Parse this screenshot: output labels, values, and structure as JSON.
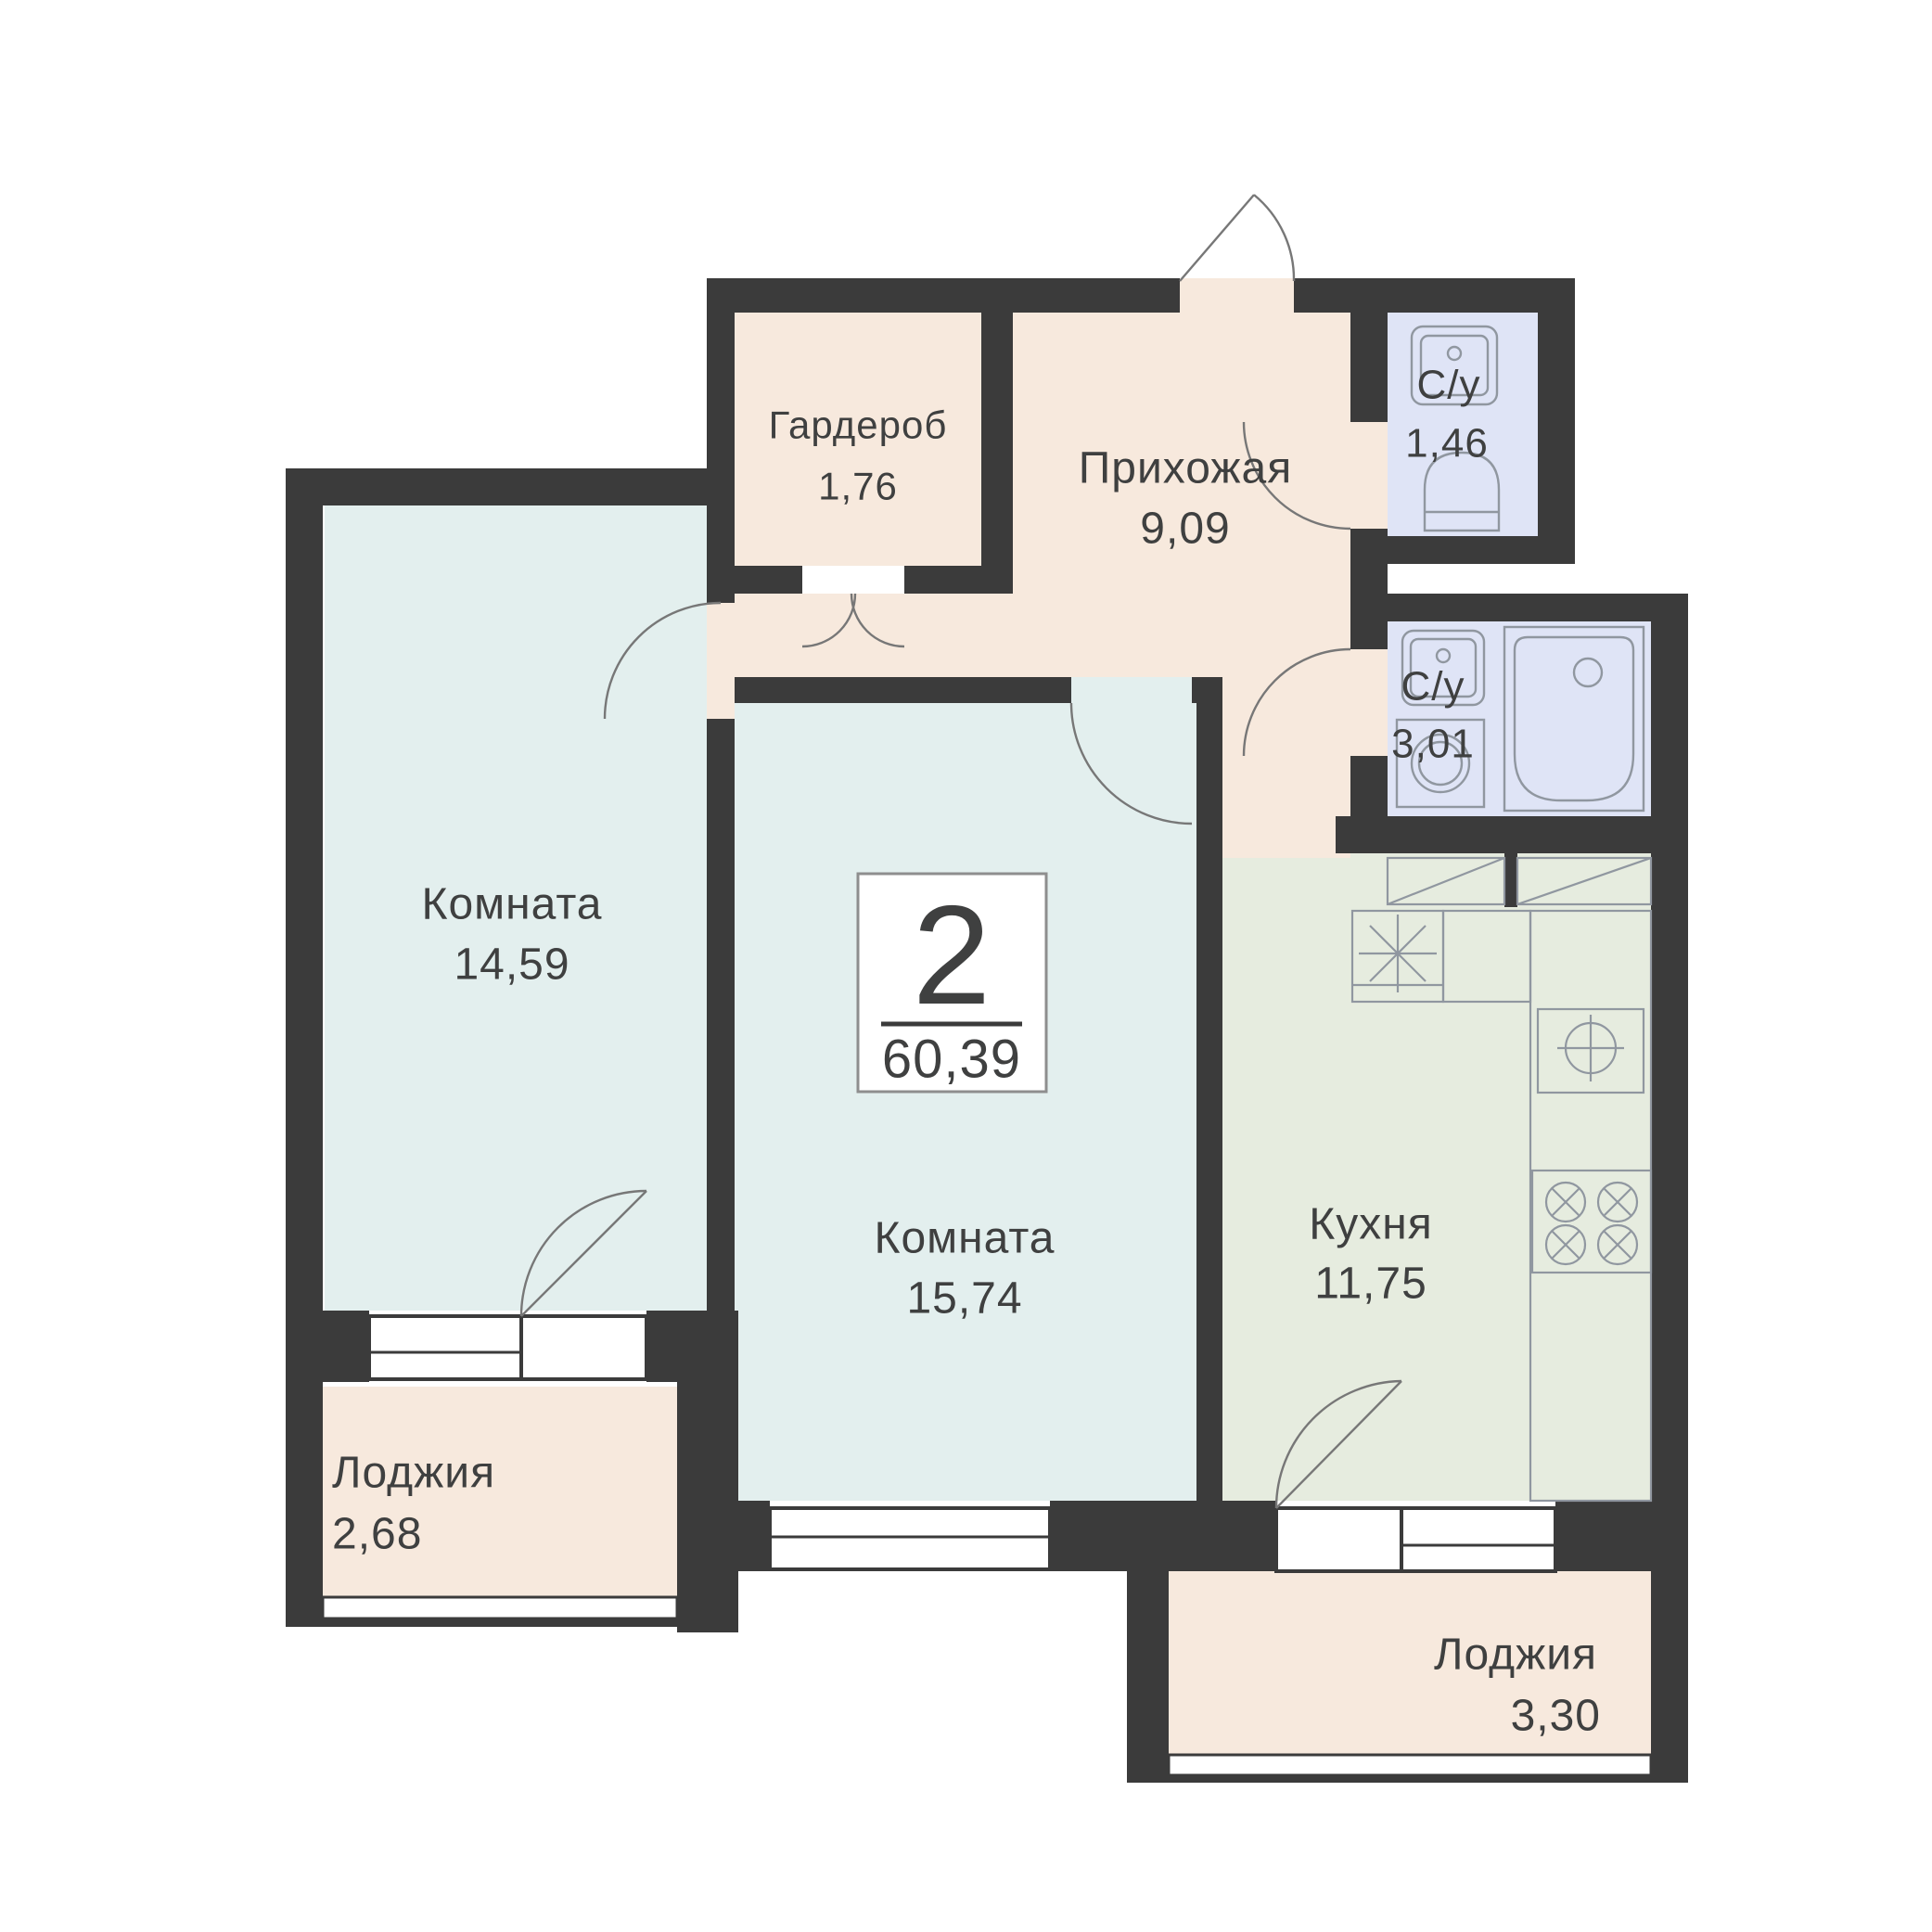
{
  "plan": {
    "badge": {
      "rooms_count": "2",
      "total_area": "60,39"
    },
    "rooms": [
      {
        "id": "wardrobe",
        "name": "Гардероб",
        "area": "1,76"
      },
      {
        "id": "hallway",
        "name": "Прихожая",
        "area": "9,09"
      },
      {
        "id": "bathroom-small",
        "name": "С/у",
        "area": "1,46"
      },
      {
        "id": "bathroom-large",
        "name": "С/у",
        "area": "3,01"
      },
      {
        "id": "living-room-1",
        "name": "Комната",
        "area": "14,59"
      },
      {
        "id": "living-room-2",
        "name": "Комната",
        "area": "15,74"
      },
      {
        "id": "kitchen",
        "name": "Кухня",
        "area": "11,75"
      },
      {
        "id": "loggia-1",
        "name": "Лоджия",
        "area": "2,68"
      },
      {
        "id": "loggia-2",
        "name": "Лоджия",
        "area": "3,30"
      }
    ],
    "colors": {
      "wall": "#3b3b3b",
      "room": "#e3efee",
      "hall": "#f7e9dd",
      "bath": "#dfe4f6",
      "kitchen": "#e6ecdf",
      "text": "#3f4040",
      "fixture": "#9097a0",
      "arc": "#777777",
      "badge-border": "#8e8e8e"
    }
  }
}
